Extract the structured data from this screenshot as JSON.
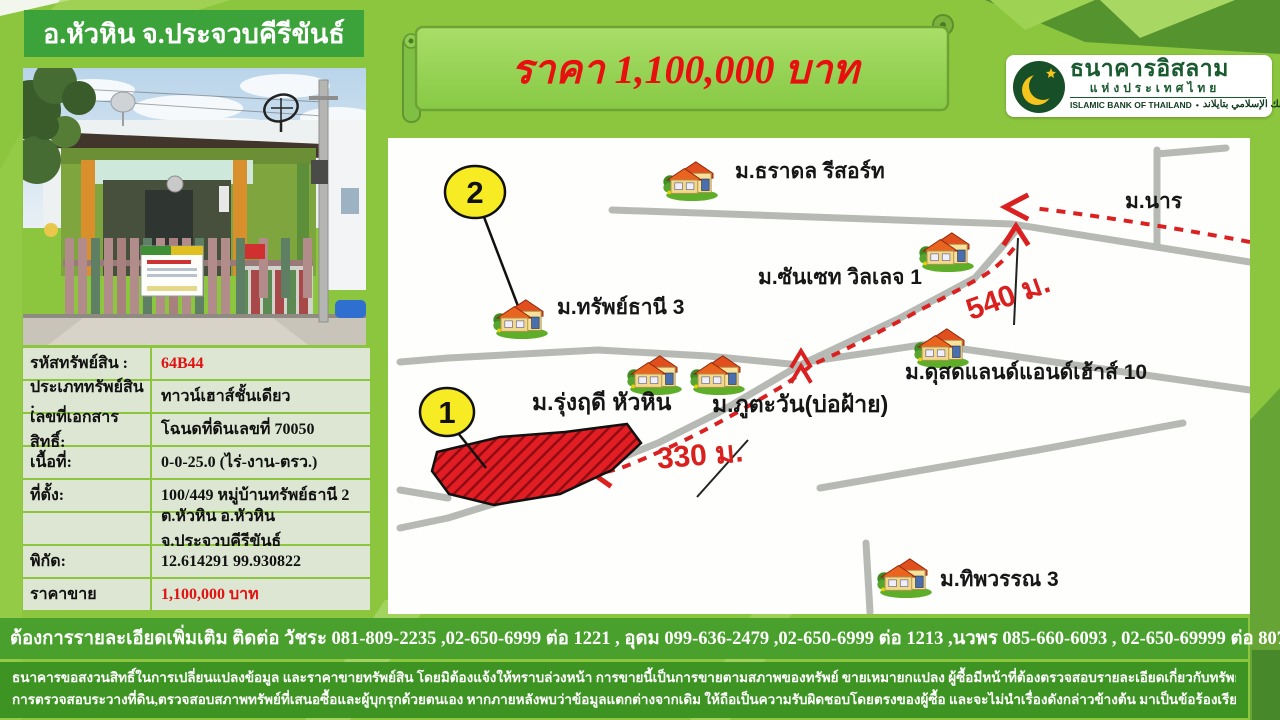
{
  "colors": {
    "background": "#8cc63e",
    "header_green": "#3ba33a",
    "table_row": "#dde6d2",
    "banner_fill": "#95d153",
    "contact_bar": "#4aa02d",
    "disclaimer_bar": "#3e9423",
    "accent_red": "#e81010",
    "route_red": "#da2020",
    "road_gray": "#b7bab4",
    "marker_yellow": "#f7ec23"
  },
  "header": {
    "title": "อ.หัวหิน จ.ประจวบคีรีขันธ์"
  },
  "banner": {
    "price_text": "ราคา 1,100,000 บาท"
  },
  "logo": {
    "thai_name": "ธนาคารอิสลาม",
    "thai_subname": "แห่งประเทศไทย",
    "eng_name": "ISLAMIC BANK OF THAILAND",
    "separator": "•",
    "arabic_name": "البنك الإسلامي بتايلاند"
  },
  "property": {
    "rows": [
      {
        "label": "รหัสทรัพย์สิน :",
        "value": "64B44"
      },
      {
        "label": "ประเภททรัพย์สิน :",
        "value": "ทาวน์เฮาส์ชั้นเดียว"
      },
      {
        "label": "เลขที่เอกสารสิทธิ์:",
        "value": "โฉนดที่ดินเลขที่ 70050"
      },
      {
        "label": "เนื้อที่:",
        "value": "0-0-25.0 (ไร่-งาน-ตรว.)"
      },
      {
        "label": "ที่ตั้ง:",
        "value": "100/449 หมู่บ้านทรัพย์ธานี  2"
      },
      {
        "label": "",
        "value": "ต.หัวหิน อ.หัวหิน จ.ประจวบคีรีขันธ์"
      },
      {
        "label": "พิกัด:",
        "value": "12.614291  99.930822"
      },
      {
        "label": "ราคาขาย",
        "value": "1,100,000 บาท"
      }
    ]
  },
  "map": {
    "labels": {
      "tharadol": "ม.ธราดล รีสอร์ท",
      "nara": "ม.นาร",
      "sunset": "ม.ซันเซท วิลเลจ 1",
      "sapthani": "ม.ทรัพย์ธานี 3",
      "rungrudee": "ม.รุ่งฤดี หัวหิน",
      "phutawan": "ม.ภูตะวัน(บ่อฝ้าย)",
      "dusitland": "ม.ดุสดแลนด์แอนด์เฮ้าส์ 10",
      "thipawan": "ม.ทิพวรรณ 3"
    },
    "distances": {
      "d540": "540 ม.",
      "d330": "330 ม."
    },
    "markers": {
      "m1": "1",
      "m2": "2"
    }
  },
  "contact": {
    "text": "ต้องการรายละเอียดเพิ่มเติม ติดต่อ วัชระ 081-809-2235 ,02-650-6999 ต่อ 1221  , อุดม 099-636-2479 ,02-650-6999 ต่อ 1213 ,นวพร 085-660-6093 , 02-650-69999 ต่อ 8075"
  },
  "disclaimer": {
    "line1": "ธนาคารขอสงวนสิทธิ์ในการเปลี่ยนแปลงข้อมูล และราคาขายทรัพย์สิน โดยมิต้องแจ้งให้ทราบล่วงหน้า การขายนี้เป็นการขายตามสภาพของทรัพย์ ขายเหมายกแปลง ผู้ซื้อมีหน้าที่ต้องตรวจสอบรายละเอียดเกี่ยวกับทรัพย์ฯ สถานที่ตั้งทรัพย์,แผนที่การเดินทาง,",
    "line2": "การตรวจสอบระวางที่ดิน,ตรวจสอบสภาพทรัพย์ที่เสนอซื้อและผู้บุกรุกด้วยตนเอง หากภายหลังพบว่าข้อมูลแตกต่างจากเดิม ให้ถือเป็นความรับผิดชอบโดยตรงของผู้ซื้อ และจะไม่นำเรื่องดังกล่าวข้างต้น มาเป็นข้อร้องเรียน/ข้อเรียกร้องใดๆต่อธนาคาร"
  }
}
